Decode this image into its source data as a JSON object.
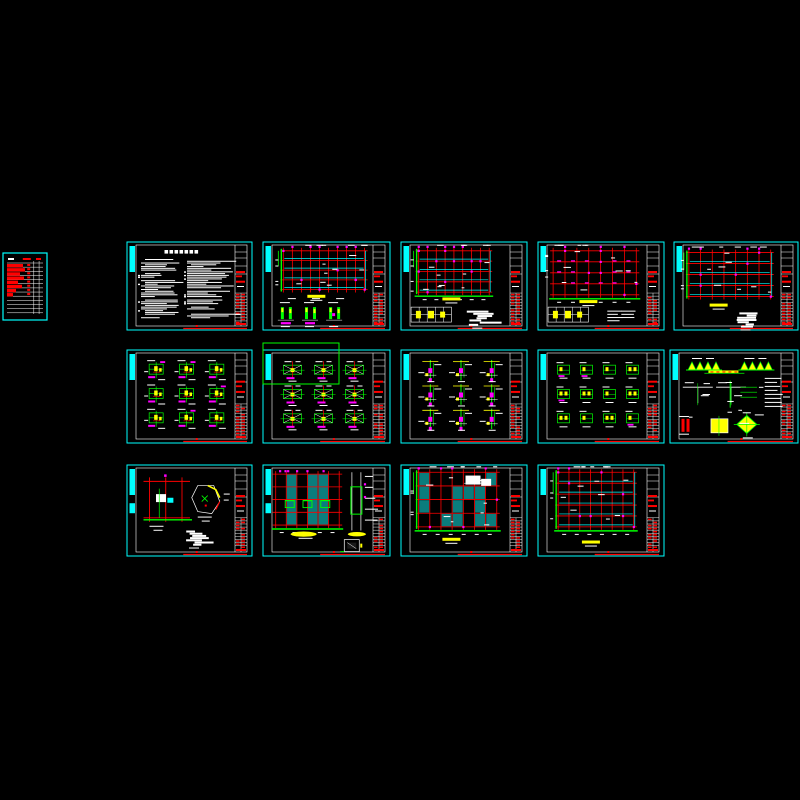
{
  "app": {
    "kind": "cad-model-space-overview",
    "background": "#000000",
    "canvas": {
      "width": 800,
      "height": 800
    }
  },
  "palette": {
    "frame": "#00ffff",
    "grid": "#ff0000",
    "member": "#00ff00",
    "highlight": "#ffff00",
    "marker": "#ff00ff",
    "ink": "#ffffff",
    "teal_fill": "#0a7d7d",
    "selection": "#00ff00"
  },
  "selection_box": {
    "x": 263,
    "y": 343,
    "w": 76,
    "h": 41
  },
  "sheets": [
    {
      "id": 0,
      "name": "drawing-index-thumbnail",
      "x": 3,
      "y": 253,
      "w": 44,
      "h": 67,
      "type": "index",
      "seed": 11
    },
    {
      "id": 1,
      "name": "general-notes-sheet",
      "x": 127,
      "y": 242,
      "w": 125,
      "h": 88,
      "type": "notes",
      "seed": 21
    },
    {
      "id": 2,
      "name": "framing-plan-1",
      "x": 263,
      "y": 242,
      "w": 127,
      "h": 88,
      "type": "plan",
      "seed": 31,
      "opt": {
        "cols": 10,
        "rows": 5,
        "cyan": "h",
        "greenLeft": true,
        "greenBottom": false,
        "mdots": 14,
        "mdash": false,
        "ybar": [
          0.42,
          0.6
        ],
        "bottom": "hatch3",
        "px": 0.16,
        "py": 0.1,
        "pw": 0.64,
        "ph": 0.44,
        "whiteTR": false
      }
    },
    {
      "id": 3,
      "name": "framing-plan-2",
      "x": 401,
      "y": 242,
      "w": 126,
      "h": 88,
      "type": "plan",
      "seed": 41,
      "opt": {
        "cols": 9,
        "rows": 5,
        "cyan": "h",
        "greenLeft": true,
        "greenBottom": true,
        "mdots": 16,
        "mdash": false,
        "ybar": [
          0.4,
          0.63
        ],
        "bottom": "tableblob",
        "px": 0.14,
        "py": 0.1,
        "pw": 0.56,
        "ph": 0.47,
        "whiteTR": false
      }
    },
    {
      "id": 4,
      "name": "framing-plan-3",
      "x": 538,
      "y": 242,
      "w": 126,
      "h": 88,
      "type": "plan",
      "seed": 51,
      "opt": {
        "cols": 8,
        "rows": 5,
        "cyan": "none",
        "greenLeft": false,
        "greenBottom": true,
        "mdots": 10,
        "mdash": true,
        "ybar": [
          0.4,
          0.66
        ],
        "bottom": "tabletext",
        "px": 0.12,
        "py": 0.1,
        "pw": 0.66,
        "ph": 0.5,
        "whiteTR": false
      }
    },
    {
      "id": 5,
      "name": "framing-plan-4",
      "x": 674,
      "y": 242,
      "w": 124,
      "h": 88,
      "type": "plan",
      "seed": 61,
      "opt": {
        "cols": 8,
        "rows": 5,
        "cyan": "h",
        "greenLeft": true,
        "greenBottom": false,
        "mdots": 10,
        "mdash": false,
        "ybar": [
          0.36,
          0.7
        ],
        "bottom": "blob",
        "px": 0.12,
        "py": 0.12,
        "pw": 0.66,
        "ph": 0.5,
        "whiteTR": false
      }
    },
    {
      "id": 6,
      "name": "joint-details-sheet-1",
      "x": 127,
      "y": 350,
      "w": 125,
      "h": 93,
      "type": "details",
      "seed": 71,
      "opt": {
        "rows": 3,
        "cols": 3,
        "style": "joint"
      }
    },
    {
      "id": 7,
      "name": "joint-details-sheet-2",
      "x": 263,
      "y": 350,
      "w": 127,
      "h": 93,
      "type": "details",
      "seed": 81,
      "opt": {
        "rows": 3,
        "cols": 3,
        "style": "brace"
      }
    },
    {
      "id": 8,
      "name": "column-details-sheet",
      "x": 401,
      "y": 350,
      "w": 126,
      "h": 93,
      "type": "details",
      "seed": 91,
      "opt": {
        "rows": 3,
        "cols": 3,
        "style": "column"
      }
    },
    {
      "id": 9,
      "name": "member-details-sheet",
      "x": 538,
      "y": 350,
      "w": 126,
      "h": 93,
      "type": "details",
      "seed": 101,
      "opt": {
        "rows": 3,
        "cols": 4,
        "style": "compact"
      }
    },
    {
      "id": 10,
      "name": "stair-misc-details-sheet",
      "x": 670,
      "y": 350,
      "w": 128,
      "h": 93,
      "type": "misc",
      "seed": 111
    },
    {
      "id": 11,
      "name": "foundation-details-sheet",
      "x": 127,
      "y": 465,
      "w": 125,
      "h": 91,
      "type": "two",
      "seed": 121,
      "tab2": true
    },
    {
      "id": 12,
      "name": "slab-plan-with-section",
      "x": 263,
      "y": 465,
      "w": 127,
      "h": 91,
      "type": "plansec",
      "seed": 131,
      "tab2": true
    },
    {
      "id": 13,
      "name": "slab-plan-2",
      "x": 401,
      "y": 465,
      "w": 126,
      "h": 91,
      "type": "plan",
      "seed": 141,
      "opt": {
        "cols": 8,
        "rows": 5,
        "cyan": "fill",
        "greenLeft": true,
        "greenBottom": true,
        "mdots": 8,
        "mdash": false,
        "ybar": [
          0.4,
          0.8
        ],
        "bottom": null,
        "px": 0.14,
        "py": 0.08,
        "pw": 0.62,
        "ph": 0.6,
        "whiteTR": true
      }
    },
    {
      "id": 14,
      "name": "slab-plan-3",
      "x": 538,
      "y": 465,
      "w": 126,
      "h": 91,
      "type": "plan",
      "seed": 151,
      "opt": {
        "cols": 8,
        "rows": 6,
        "cyan": "h",
        "greenLeft": true,
        "greenBottom": true,
        "mdots": 10,
        "mdash": false,
        "ybar": [
          0.42,
          0.83
        ],
        "bottom": null,
        "px": 0.16,
        "py": 0.08,
        "pw": 0.6,
        "ph": 0.6,
        "whiteTR": false
      }
    }
  ]
}
